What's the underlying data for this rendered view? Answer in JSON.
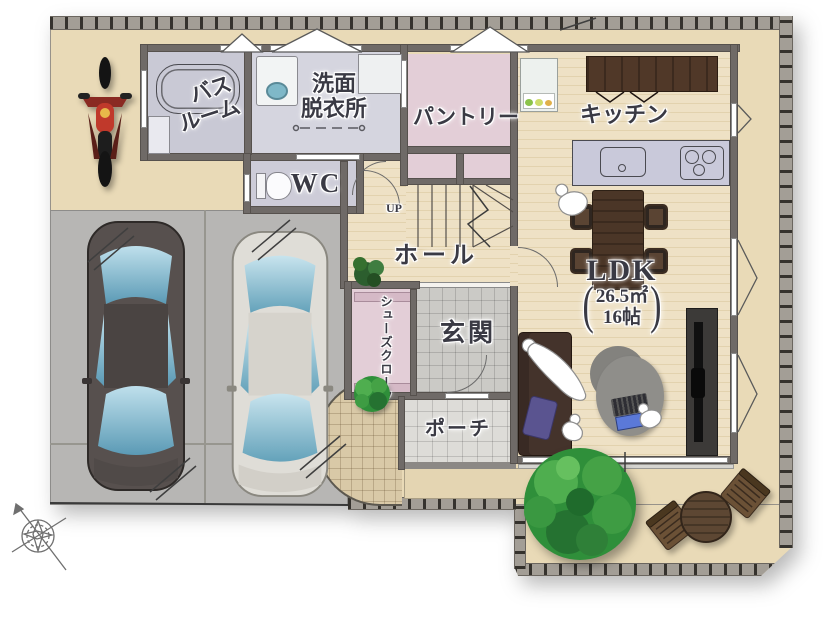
{
  "floorplan": {
    "rooms": {
      "bathroom": {
        "line1": "バス",
        "line2": "ルーム"
      },
      "washroom": {
        "line1": "洗面",
        "line2": "脱衣所"
      },
      "wc": {
        "label": "WC"
      },
      "pantry": {
        "label": "パントリー"
      },
      "kitchen": {
        "label": "キッチン"
      },
      "stairs": {
        "label": "UP"
      },
      "hall": {
        "label": "ホール"
      },
      "shoe_closet": {
        "label": "シューズクローク"
      },
      "entrance": {
        "label": "玄関"
      },
      "porch": {
        "label": "ポーチ"
      },
      "ldk": {
        "label": "LDK",
        "paren_open": "(",
        "area_m2": "26.5㎡",
        "area_tatami": "16帖",
        "paren_close": ")"
      }
    },
    "colors": {
      "ground": "#e9dab7",
      "driveway": "#b7b6b4",
      "wall": "#6f6a67",
      "wood_floor": "#ecdfc2",
      "pantry_pink": "#e3ced7",
      "bath_lavender": "#cbcbd7",
      "entry_tile": "#cbcac6",
      "tree_green": "#3fa04a",
      "furniture_wood": "#4b3627",
      "window_glass_blue": "#8fc3d6"
    }
  }
}
